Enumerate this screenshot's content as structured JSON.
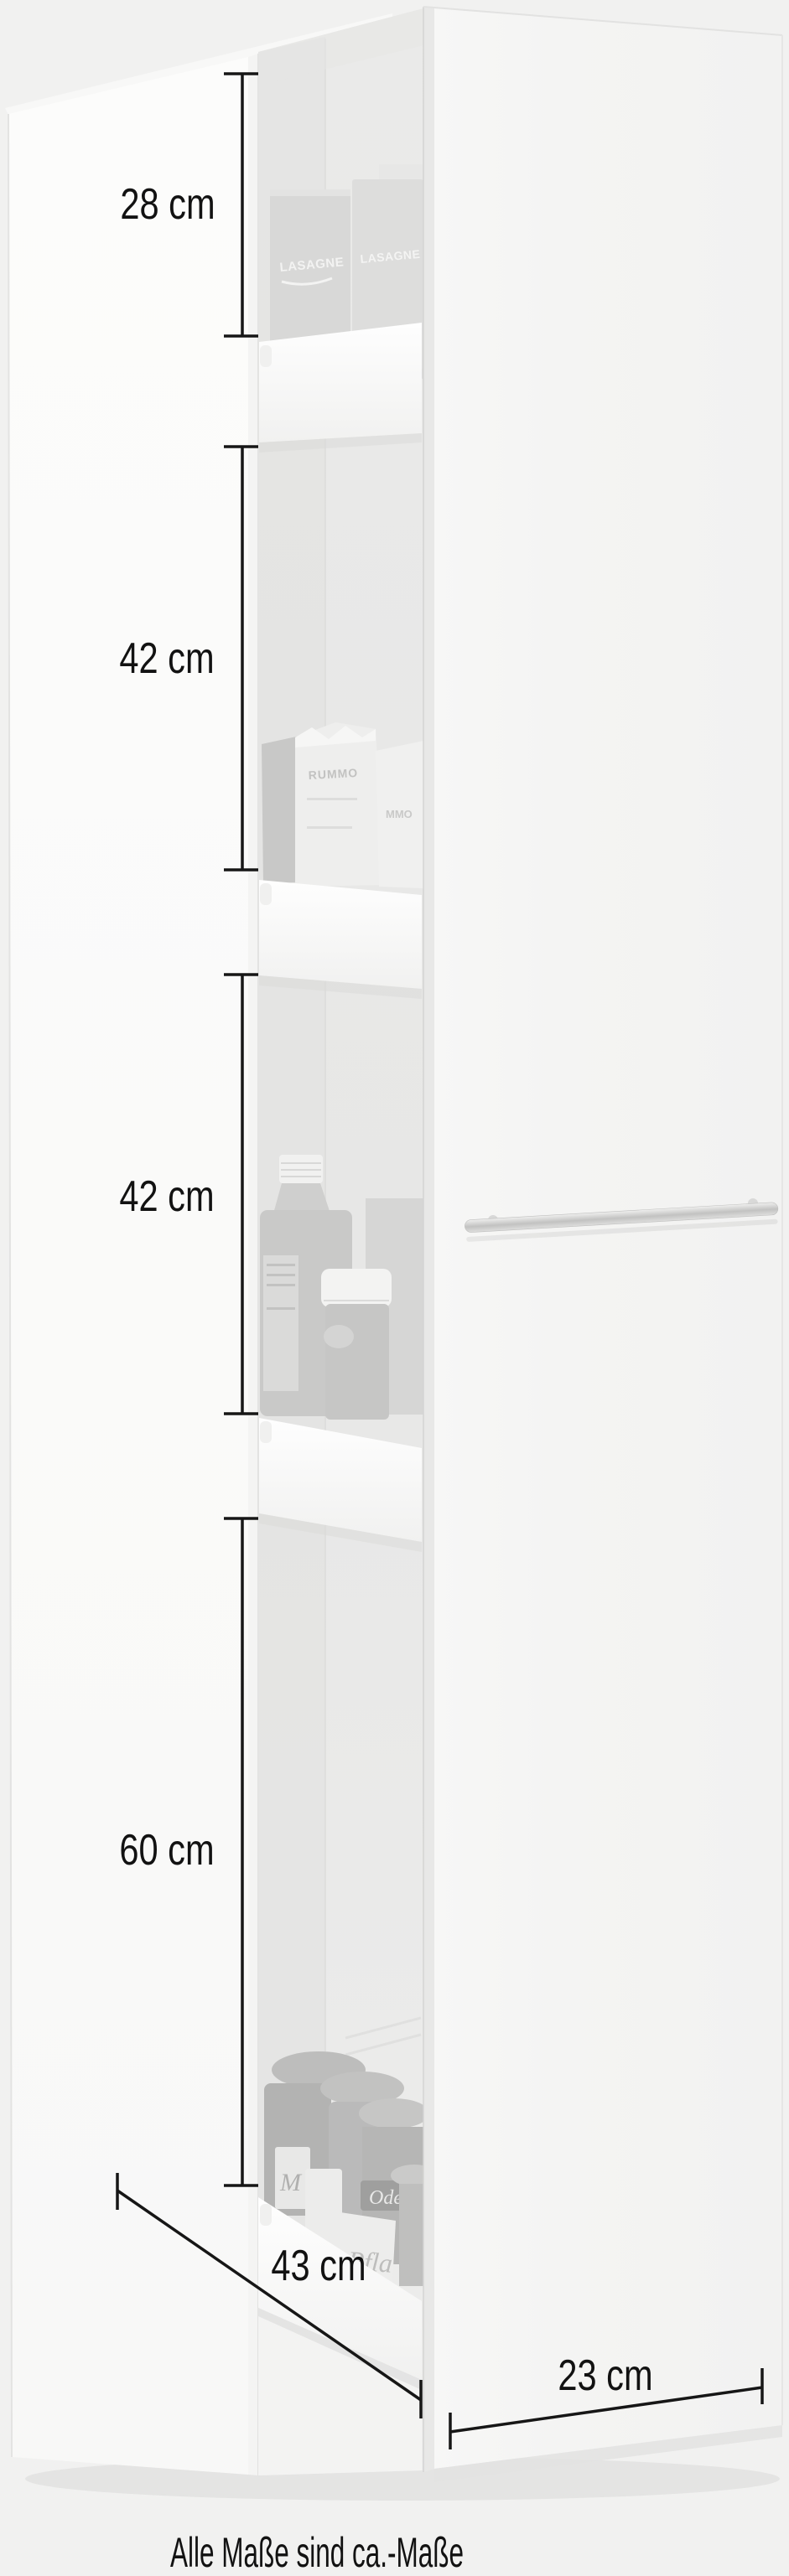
{
  "image_type": "furniture product dimension illustration",
  "product": {
    "description": "narrow white pull-out larder cabinet, open, four pull-out shelves with groceries, open door with bar handle",
    "shelf_items": {
      "bay1": {
        "box1_text": "LASAGNE",
        "box2_text": "LASAGNE"
      },
      "bay2": {
        "bag1_text": "RUMMO",
        "bag2_text": "MMO"
      },
      "bay4": {
        "jar_band_text": "Ode",
        "jar_label_text": "Pfla",
        "jar_small_text": "M"
      }
    }
  },
  "dimensions": {
    "unit": "cm",
    "height_segments": [
      {
        "label": "28 cm",
        "value": 28
      },
      {
        "label": "42 cm",
        "value": 42
      },
      {
        "label": "42 cm",
        "value": 42
      },
      {
        "label": "60 cm",
        "value": 60
      }
    ],
    "depth": {
      "label": "43 cm",
      "value": 43
    },
    "width": {
      "label": "23 cm",
      "value": 23
    }
  },
  "footnote": "Alle Maße sind ca.-Maße",
  "colors": {
    "background": "#f1f1f0",
    "dimension_lines": "#161616",
    "label_text": "#121212",
    "cabinet_white": "#fbfbfa",
    "interior_gray": "#e9e9e8",
    "door_white": "#f5f5f4",
    "handle_silver": "#c9c9c8"
  }
}
